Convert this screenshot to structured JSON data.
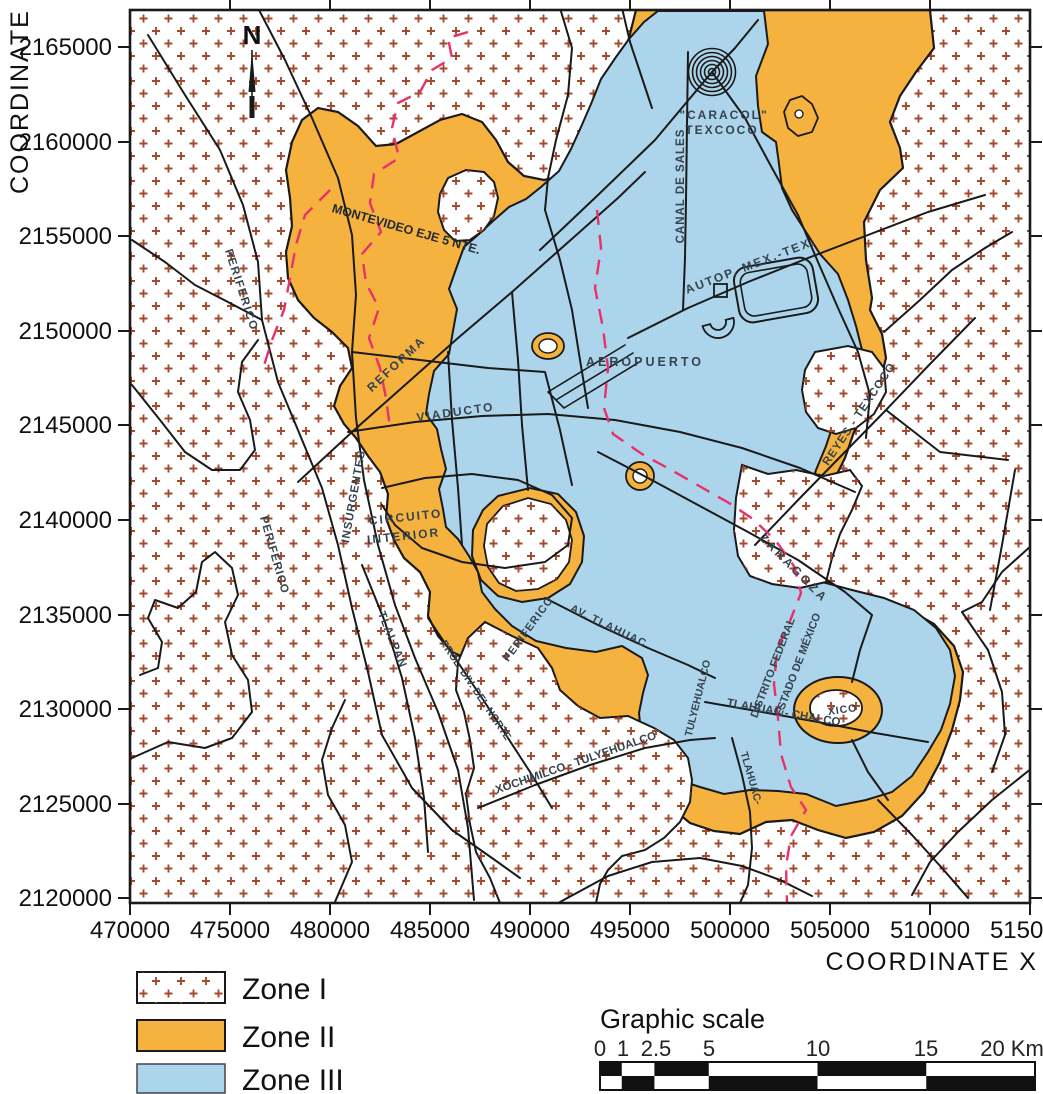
{
  "axes": {
    "x_title": "COORDINATE  X",
    "y_title": "COORDINATE  Y",
    "x_ticks": [
      "470000",
      "475000",
      "480000",
      "485000",
      "490000",
      "495000",
      "500000",
      "505000",
      "510000",
      "515000"
    ],
    "y_ticks": [
      "2165000",
      "2160000",
      "2155000",
      "2150000",
      "2145000",
      "2140000",
      "2135000",
      "2130000",
      "2125000",
      "2120000"
    ]
  },
  "compass": {
    "label": "N"
  },
  "map": {
    "labels": [
      {
        "id": "montevideo",
        "text": "MONTEVIDEO EJE 5 NTE."
      },
      {
        "id": "periferico-nw",
        "text": "PERIFERICO"
      },
      {
        "id": "reforma",
        "text": "REFORMA"
      },
      {
        "id": "viaducto",
        "text": "VIADUCTO"
      },
      {
        "id": "circuito-line1",
        "text": "CIRCUITO"
      },
      {
        "id": "circuito-line2",
        "text": "INTERIOR"
      },
      {
        "id": "insurgentes",
        "text": "INSURGENTES"
      },
      {
        "id": "periferico-w",
        "text": "PERIFERICO"
      },
      {
        "id": "tlalpan",
        "text": "TLALPAN"
      },
      {
        "id": "prol-div-norte",
        "text": "PROL. DIV. DEL NORTE"
      },
      {
        "id": "xochimilco-tulyehualco",
        "text": "XOCHIMILCO - TULYEHUALCO"
      },
      {
        "id": "periferico-s",
        "text": "PERIFERICO"
      },
      {
        "id": "av-tlahuac",
        "text": "AV. TLAHUAC"
      },
      {
        "id": "tulyehualco",
        "text": "TULYEHUALCO"
      },
      {
        "id": "tlahuac-chalco",
        "text": "TLAHUAC - CHALCO"
      },
      {
        "id": "tlahuac-vertical",
        "text": "TLAHUAC-"
      },
      {
        "id": "distrito-federal",
        "text": "DISTRITO FEDERAL"
      },
      {
        "id": "estado-mexico",
        "text": "ESTADO DE MÉXICO"
      },
      {
        "id": "zaragoza",
        "text": "ZARAGOZA"
      },
      {
        "id": "reyes-texcoco",
        "text": "REYES - TEXCOCO"
      },
      {
        "id": "canal-de-sales",
        "text": "CANAL DE SALES"
      },
      {
        "id": "autop-mex-tex",
        "text": "AUTOP. MEX.-TEX."
      },
      {
        "id": "caracol-line1",
        "text": "\"CARACOL\""
      },
      {
        "id": "caracol-line2",
        "text": "TEXCOCO"
      },
      {
        "id": "aeropuerto",
        "text": "AEROPUERTO"
      },
      {
        "id": "xico",
        "text": "XICO"
      }
    ]
  },
  "legend": {
    "items": [
      {
        "label": "Zone I",
        "zone": "zone1-pattern"
      },
      {
        "label": "Zone II",
        "zone": "zone2-orange"
      },
      {
        "label": "Zone III",
        "zone": "zone3-blue"
      }
    ]
  },
  "scale": {
    "title": "Graphic scale",
    "ticks": [
      "0",
      "1",
      "2.5",
      "5",
      "10",
      "15",
      "20 Km"
    ]
  },
  "colors": {
    "zone2_orange": "#F6B23E",
    "zone3_blue": "#ACD5EB",
    "zone1_cross": "#A34A2C",
    "boundary_red": "#E8316A",
    "line_black": "#1A1A1A"
  }
}
